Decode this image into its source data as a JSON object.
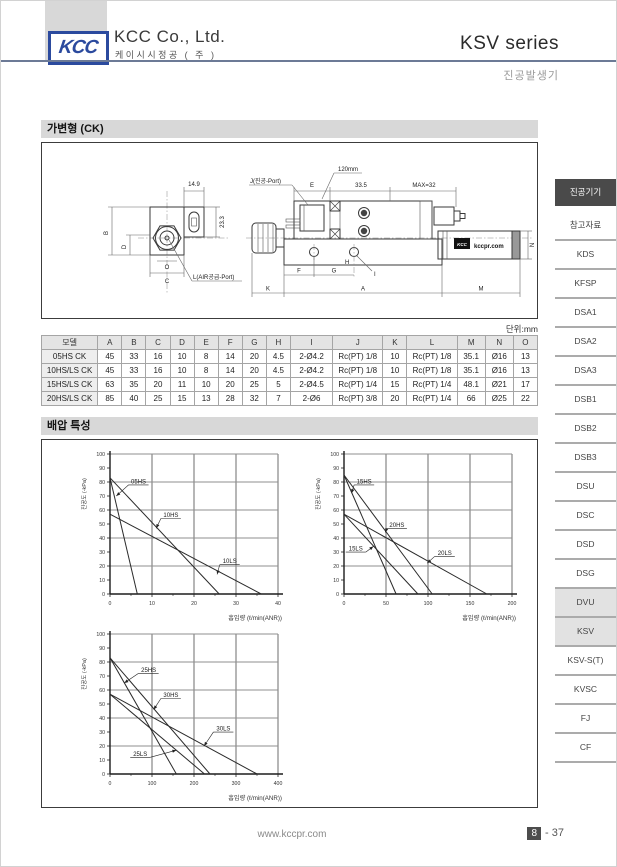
{
  "header": {
    "logo_text": "KCC",
    "company_name": "KCC Co., Ltd.",
    "company_subtitle": "케이시시정공 ( 주 )",
    "series_title": "KSV series",
    "product_type": "진공발생기"
  },
  "sections": {
    "variable_title": "가변형 (CK)",
    "backpressure_title": "배압 특성"
  },
  "drawing": {
    "dim_14_9": "14.9",
    "dim_23_3": "23.3",
    "dim_B": "B",
    "dim_D": "D",
    "dim_O": "O",
    "dim_C": "C",
    "air_port_label": "L(AIR공급-Port)",
    "vacuum_port_label": "J(진공-Port)",
    "dim_E": "E",
    "callout_120": "120mm",
    "dim_33_5": "33.5",
    "dim_max32": "MAX=32",
    "dim_F": "F",
    "dim_G": "G",
    "dim_H": "H",
    "dim_I": "I",
    "dim_K": "K",
    "dim_A": "A",
    "dim_M": "M",
    "dim_N": "N",
    "brand_logo": "KCC",
    "brand_text": "kccpr.com"
  },
  "table": {
    "units_label": "단위:mm",
    "headers": [
      "모델",
      "A",
      "B",
      "C",
      "D",
      "E",
      "F",
      "G",
      "H",
      "I",
      "J",
      "K",
      "L",
      "M",
      "N",
      "O"
    ],
    "rows": [
      [
        "05HS CK",
        "45",
        "33",
        "16",
        "10",
        "8",
        "14",
        "20",
        "4.5",
        "2-Ø4.2",
        "Rc(PT) 1/8",
        "10",
        "Rc(PT) 1/8",
        "35.1",
        "Ø16",
        "13"
      ],
      [
        "10HS/LS CK",
        "45",
        "33",
        "16",
        "10",
        "8",
        "14",
        "20",
        "4.5",
        "2-Ø4.2",
        "Rc(PT) 1/8",
        "10",
        "Rc(PT) 1/8",
        "35.1",
        "Ø16",
        "13"
      ],
      [
        "15HS/LS CK",
        "63",
        "35",
        "20",
        "11",
        "10",
        "20",
        "25",
        "5",
        "2-Ø4.5",
        "Rc(PT) 1/4",
        "15",
        "Rc(PT) 1/4",
        "48.1",
        "Ø21",
        "17"
      ],
      [
        "20HS/LS CK",
        "85",
        "40",
        "25",
        "15",
        "13",
        "28",
        "32",
        "7",
        "2-Ø6",
        "Rc(PT) 3/8",
        "20",
        "Rc(PT) 1/4",
        "66",
        "Ø25",
        "22"
      ]
    ]
  },
  "chart_data": [
    {
      "type": "line",
      "ylabel": "진공도 (-kPa)",
      "xlabel": "흡입량 (ℓ/min(ANR))",
      "xlim": [
        0,
        40
      ],
      "ylim": [
        0,
        100
      ],
      "xticks": [
        0,
        10,
        20,
        30,
        40
      ],
      "yticks": [
        0,
        10,
        20,
        30,
        40,
        50,
        60,
        70,
        80,
        90,
        100
      ],
      "grid_y_step": 20,
      "series": [
        {
          "name": "05HS",
          "points": [
            [
              0,
              83
            ],
            [
              6.5,
              0
            ]
          ],
          "label_at": [
            6.8,
            79
          ],
          "arrow_to": [
            1.5,
            70
          ]
        },
        {
          "name": "10HS",
          "points": [
            [
              0,
              83
            ],
            [
              26,
              0
            ]
          ],
          "label_at": [
            14.5,
            55
          ],
          "arrow_to": [
            11,
            47
          ]
        },
        {
          "name": "10LS",
          "points": [
            [
              0,
              57
            ],
            [
              36,
              0
            ]
          ],
          "label_at": [
            28.5,
            22
          ],
          "arrow_to": [
            25.5,
            14
          ]
        }
      ]
    },
    {
      "type": "line",
      "ylabel": "진공도 (-kPa)",
      "xlabel": "흡입량 (ℓ/min(ANR))",
      "xlim": [
        0,
        200
      ],
      "ylim": [
        0,
        100
      ],
      "xticks": [
        0,
        50,
        100,
        150,
        200
      ],
      "yticks": [
        0,
        10,
        20,
        30,
        40,
        50,
        60,
        70,
        80,
        90,
        100
      ],
      "grid_y_step": 20,
      "series": [
        {
          "name": "15HS",
          "points": [
            [
              0,
              85
            ],
            [
              62,
              0
            ]
          ],
          "label_at": [
            24,
            79
          ],
          "arrow_to": [
            9,
            72
          ]
        },
        {
          "name": "20HS",
          "points": [
            [
              0,
              85
            ],
            [
              105,
              0
            ]
          ],
          "label_at": [
            63,
            48
          ],
          "arrow_to": [
            49,
            44
          ]
        },
        {
          "name": "15LS",
          "points": [
            [
              0,
              57
            ],
            [
              88,
              0
            ]
          ],
          "label_at": [
            14,
            31
          ],
          "arrow_to": [
            35,
            34
          ]
        },
        {
          "name": "20LS",
          "points": [
            [
              0,
              57
            ],
            [
              170,
              0
            ]
          ],
          "label_at": [
            120,
            28
          ],
          "arrow_to": [
            99,
            22
          ]
        }
      ]
    },
    {
      "type": "line",
      "ylabel": "진공도 (-kPa)",
      "xlabel": "흡입량 (ℓ/min(ANR))",
      "xlim": [
        0,
        400
      ],
      "ylim": [
        0,
        100
      ],
      "xticks": [
        0,
        100,
        200,
        300,
        400
      ],
      "yticks": [
        0,
        10,
        20,
        30,
        40,
        50,
        60,
        70,
        80,
        90,
        100
      ],
      "grid_y_step": 20,
      "series": [
        {
          "name": "25HS",
          "points": [
            [
              0,
              83
            ],
            [
              158,
              0
            ]
          ],
          "label_at": [
            92,
            73
          ],
          "arrow_to": [
            34,
            65
          ]
        },
        {
          "name": "30HS",
          "points": [
            [
              0,
              83
            ],
            [
              238,
              0
            ]
          ],
          "label_at": [
            145,
            55
          ],
          "arrow_to": [
            104,
            46
          ]
        },
        {
          "name": "25LS",
          "points": [
            [
              0,
              57
            ],
            [
              225,
              0
            ]
          ],
          "label_at": [
            72,
            13
          ],
          "arrow_to": [
            158,
            17
          ]
        },
        {
          "name": "30LS",
          "points": [
            [
              0,
              57
            ],
            [
              350,
              0
            ]
          ],
          "label_at": [
            270,
            31
          ],
          "arrow_to": [
            224,
            20
          ]
        }
      ]
    }
  ],
  "sidebar": {
    "items": [
      {
        "label": "진공기기",
        "style": "dark"
      },
      {
        "label": "참고자료",
        "style": "plain"
      },
      {
        "label": "KDS",
        "style": "plain"
      },
      {
        "label": "KFSP",
        "style": "plain"
      },
      {
        "label": "DSA1",
        "style": "plain"
      },
      {
        "label": "DSA2",
        "style": "plain"
      },
      {
        "label": "DSA3",
        "style": "plain"
      },
      {
        "label": "DSB1",
        "style": "plain"
      },
      {
        "label": "DSB2",
        "style": "plain"
      },
      {
        "label": "DSB3",
        "style": "plain"
      },
      {
        "label": "DSU",
        "style": "plain"
      },
      {
        "label": "DSC",
        "style": "plain"
      },
      {
        "label": "DSD",
        "style": "plain"
      },
      {
        "label": "DSG",
        "style": "plain"
      },
      {
        "label": "DVU",
        "style": "active"
      },
      {
        "label": "KSV",
        "style": "active"
      },
      {
        "label": "KSV-S(T)",
        "style": "plain"
      },
      {
        "label": "KVSC",
        "style": "plain"
      },
      {
        "label": "FJ",
        "style": "plain"
      },
      {
        "label": "CF",
        "style": "plain"
      }
    ]
  },
  "footer": {
    "url": "www.kccpr.com",
    "page_number": "8",
    "page_rest": "-  37"
  },
  "colors": {
    "brand_blue": "#2b4a9e",
    "header_rule": "#6c7a96",
    "sidebar_dark": "#4a4a4a",
    "sidebar_active_bg": "#e2e2e2",
    "title_bar_bg": "#d8d8d8"
  }
}
